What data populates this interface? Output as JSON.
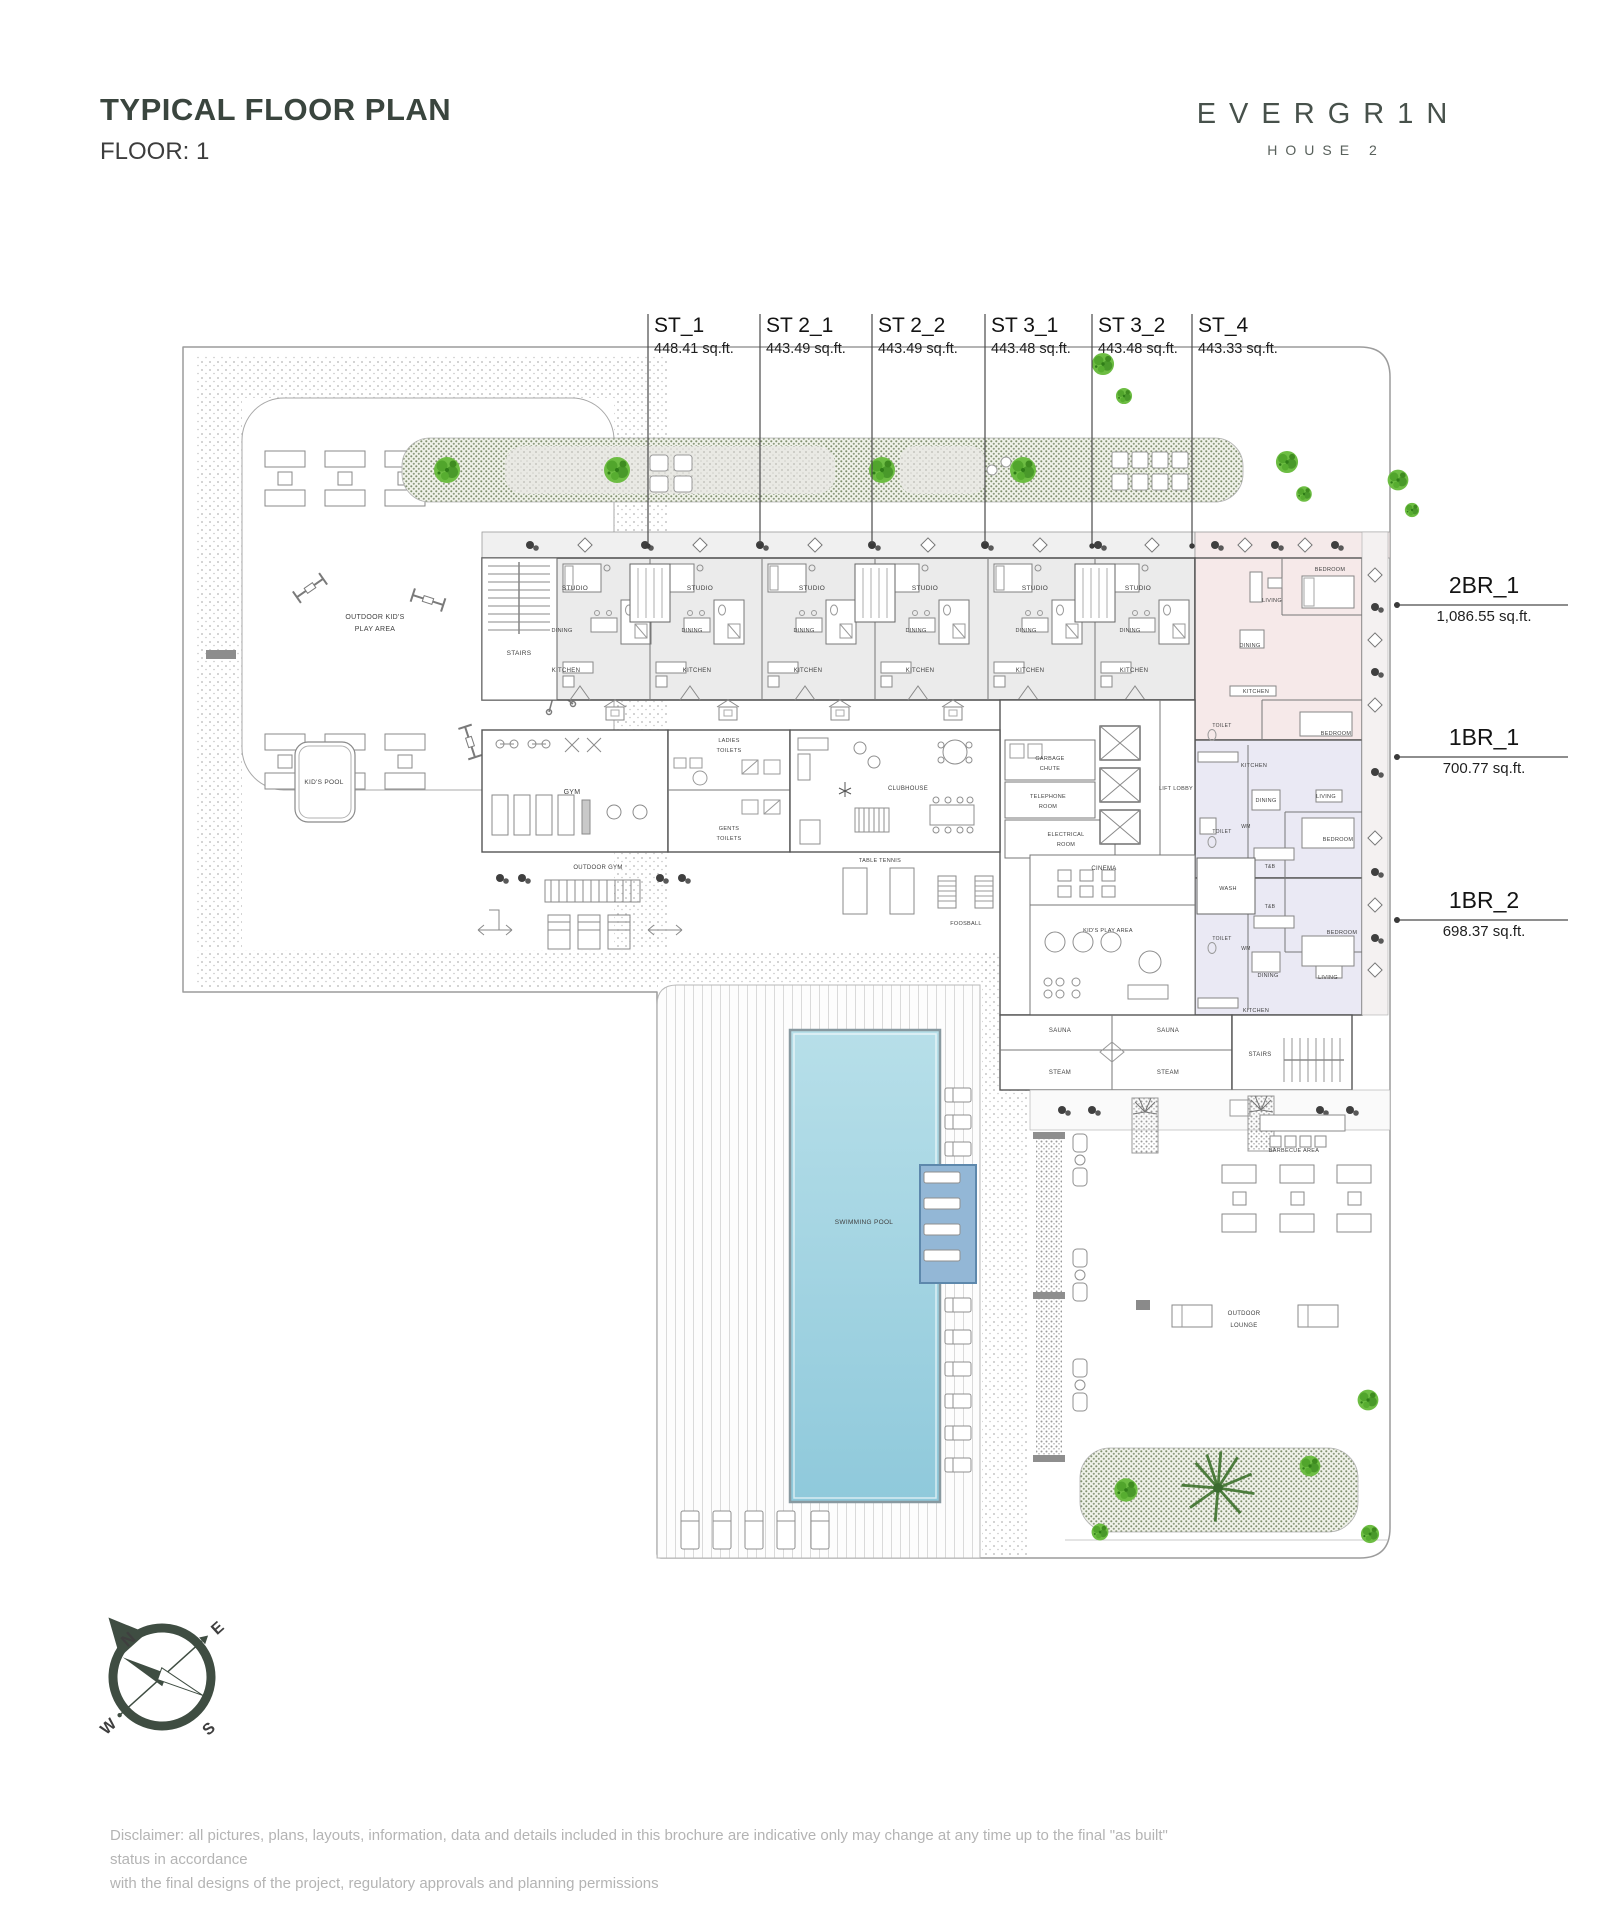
{
  "header": {
    "title": "TYPICAL FLOOR PLAN",
    "floor_label": "FLOOR: 1"
  },
  "logo": {
    "brand": "EVERGR1N",
    "sub": "HOUSE 2"
  },
  "unit_callouts": {
    "top": [
      {
        "name": "ST_1",
        "area": "448.41 sq.ft.",
        "x": 648
      },
      {
        "name": "ST 2_1",
        "area": "443.49 sq.ft.",
        "x": 760
      },
      {
        "name": "ST 2_2",
        "area": "443.49 sq.ft.",
        "x": 872
      },
      {
        "name": "ST 3_1",
        "area": "443.48 sq.ft.",
        "x": 985
      },
      {
        "name": "ST 3_2",
        "area": "443.48 sq.ft.",
        "x": 1092
      },
      {
        "name": "ST_4",
        "area": "443.33 sq.ft.",
        "x": 1192
      }
    ],
    "right": [
      {
        "name": "2BR_1",
        "area": "1,086.55 sq.ft.",
        "y": 605
      },
      {
        "name": "1BR_1",
        "area": "700.77 sq.ft.",
        "y": 757
      },
      {
        "name": "1BR_2",
        "area": "698.37 sq.ft.",
        "y": 920
      }
    ]
  },
  "compass": {
    "n": "N",
    "e": "E",
    "s": "S",
    "w": "W"
  },
  "disclaimer": {
    "line1": "Disclaimer: all pictures, plans, layouts, information, data and details included in this brochure are indicative only may change at any time up to the final \"as built\" status in accordance",
    "line2": "with the final designs of the project, regulatory approvals and planning permissions"
  },
  "plan": {
    "colors": {
      "studio_fill": "#ebebeb",
      "two_br_fill": "#f6e9e9",
      "one_br_fill": "#eae9f4",
      "pool": "#9fd2e2",
      "accent_green": "#6dbd43",
      "ink": "#3f3f3f"
    },
    "room_labels": [
      {
        "t": "OUTDOOR KID'S",
        "x": 375,
        "y": 619,
        "s": 7
      },
      {
        "t": "PLAY AREA",
        "x": 375,
        "y": 631,
        "s": 7
      },
      {
        "t": "KID'S POOL",
        "x": 324,
        "y": 784,
        "s": 6.5
      },
      {
        "t": "STAIRS",
        "x": 519,
        "y": 655,
        "s": 6.5
      },
      {
        "t": "STUDIO",
        "x": 575,
        "y": 590,
        "s": 6.5
      },
      {
        "t": "STUDIO",
        "x": 700,
        "y": 590,
        "s": 6.5
      },
      {
        "t": "STUDIO",
        "x": 812,
        "y": 590,
        "s": 6.5
      },
      {
        "t": "STUDIO",
        "x": 925,
        "y": 590,
        "s": 6.5
      },
      {
        "t": "STUDIO",
        "x": 1035,
        "y": 590,
        "s": 6.5
      },
      {
        "t": "STUDIO",
        "x": 1138,
        "y": 590,
        "s": 6.5
      },
      {
        "t": "DINING",
        "x": 562,
        "y": 632,
        "s": 5.5
      },
      {
        "t": "DINING",
        "x": 692,
        "y": 632,
        "s": 5.5
      },
      {
        "t": "DINING",
        "x": 804,
        "y": 632,
        "s": 5.5
      },
      {
        "t": "DINING",
        "x": 916,
        "y": 632,
        "s": 5.5
      },
      {
        "t": "DINING",
        "x": 1026,
        "y": 632,
        "s": 5.5
      },
      {
        "t": "DINING",
        "x": 1130,
        "y": 632,
        "s": 5.5
      },
      {
        "t": "KITCHEN",
        "x": 566,
        "y": 672,
        "s": 6
      },
      {
        "t": "KITCHEN",
        "x": 697,
        "y": 672,
        "s": 6
      },
      {
        "t": "KITCHEN",
        "x": 808,
        "y": 672,
        "s": 6
      },
      {
        "t": "KITCHEN",
        "x": 920,
        "y": 672,
        "s": 6
      },
      {
        "t": "KITCHEN",
        "x": 1030,
        "y": 672,
        "s": 6
      },
      {
        "t": "KITCHEN",
        "x": 1134,
        "y": 672,
        "s": 6
      },
      {
        "t": "GYM",
        "x": 572,
        "y": 794,
        "s": 7
      },
      {
        "t": "LADIES",
        "x": 729,
        "y": 742,
        "s": 5.5
      },
      {
        "t": "TOILETS",
        "x": 729,
        "y": 752,
        "s": 5.5
      },
      {
        "t": "GENTS",
        "x": 729,
        "y": 830,
        "s": 5.5
      },
      {
        "t": "TOILETS",
        "x": 729,
        "y": 840,
        "s": 5.5
      },
      {
        "t": "CLUBHOUSE",
        "x": 908,
        "y": 790,
        "s": 6
      },
      {
        "t": "GARBAGE",
        "x": 1050,
        "y": 760,
        "s": 5.5
      },
      {
        "t": "CHUTE",
        "x": 1050,
        "y": 770,
        "s": 5.5
      },
      {
        "t": "TELEPHONE",
        "x": 1048,
        "y": 798,
        "s": 5.5
      },
      {
        "t": "ROOM",
        "x": 1048,
        "y": 808,
        "s": 5.5
      },
      {
        "t": "ELECTRICAL",
        "x": 1066,
        "y": 836,
        "s": 5.5
      },
      {
        "t": "ROOM",
        "x": 1066,
        "y": 846,
        "s": 5.5
      },
      {
        "t": "LIFT LOBBY",
        "x": 1176,
        "y": 790,
        "s": 5.5
      },
      {
        "t": "CINEMA",
        "x": 1104,
        "y": 870,
        "s": 6
      },
      {
        "t": "KID'S PLAY AREA",
        "x": 1108,
        "y": 932,
        "s": 5.5
      },
      {
        "t": "WASH",
        "x": 1228,
        "y": 890,
        "s": 5.5
      },
      {
        "t": "T&B",
        "x": 1270,
        "y": 868,
        "s": 5
      },
      {
        "t": "T&B",
        "x": 1270,
        "y": 908,
        "s": 5
      },
      {
        "t": "TOILET",
        "x": 1222,
        "y": 727,
        "s": 5
      },
      {
        "t": "TOILET",
        "x": 1222,
        "y": 833,
        "s": 5
      },
      {
        "t": "TOILET",
        "x": 1222,
        "y": 940,
        "s": 5
      },
      {
        "t": "WM",
        "x": 1246,
        "y": 828,
        "s": 5
      },
      {
        "t": "WM",
        "x": 1246,
        "y": 950,
        "s": 5
      },
      {
        "t": "SAUNA",
        "x": 1060,
        "y": 1032,
        "s": 6
      },
      {
        "t": "SAUNA",
        "x": 1168,
        "y": 1032,
        "s": 6
      },
      {
        "t": "STEAM",
        "x": 1060,
        "y": 1074,
        "s": 6
      },
      {
        "t": "STEAM",
        "x": 1168,
        "y": 1074,
        "s": 6
      },
      {
        "t": "STAIRS",
        "x": 1260,
        "y": 1056,
        "s": 6
      },
      {
        "t": "BARBECUE AREA",
        "x": 1294,
        "y": 1152,
        "s": 5.5
      },
      {
        "t": "OUTDOOR",
        "x": 1244,
        "y": 1315,
        "s": 6
      },
      {
        "t": "LOUNGE",
        "x": 1244,
        "y": 1327,
        "s": 6
      },
      {
        "t": "SWIMMING POOL",
        "x": 864,
        "y": 1224,
        "s": 6.5
      },
      {
        "t": "TABLE TENNIS",
        "x": 880,
        "y": 862,
        "s": 5.5
      },
      {
        "t": "FOOSBALL",
        "x": 966,
        "y": 925,
        "s": 5.5
      },
      {
        "t": "OUTDOOR GYM",
        "x": 598,
        "y": 869,
        "s": 6
      },
      {
        "t": "BEDROOM",
        "x": 1330,
        "y": 571,
        "s": 5.5
      },
      {
        "t": "LIVING",
        "x": 1272,
        "y": 602,
        "s": 5.5
      },
      {
        "t": "DINING",
        "x": 1250,
        "y": 647,
        "s": 5.5
      },
      {
        "t": "KITCHEN",
        "x": 1256,
        "y": 693,
        "s": 5.5
      },
      {
        "t": "BEDROOM",
        "x": 1336,
        "y": 735,
        "s": 5.5
      },
      {
        "t": "KITCHEN",
        "x": 1254,
        "y": 767,
        "s": 5.5
      },
      {
        "t": "DINING",
        "x": 1266,
        "y": 802,
        "s": 5.5
      },
      {
        "t": "LIVING",
        "x": 1326,
        "y": 798,
        "s": 5.5
      },
      {
        "t": "BEDROOM",
        "x": 1338,
        "y": 841,
        "s": 5.5
      },
      {
        "t": "BEDROOM",
        "x": 1342,
        "y": 934,
        "s": 5.5
      },
      {
        "t": "DINING",
        "x": 1268,
        "y": 977,
        "s": 5.5
      },
      {
        "t": "LIVING",
        "x": 1328,
        "y": 979,
        "s": 5.5
      },
      {
        "t": "KITCHEN",
        "x": 1256,
        "y": 1012,
        "s": 5.5
      }
    ]
  }
}
